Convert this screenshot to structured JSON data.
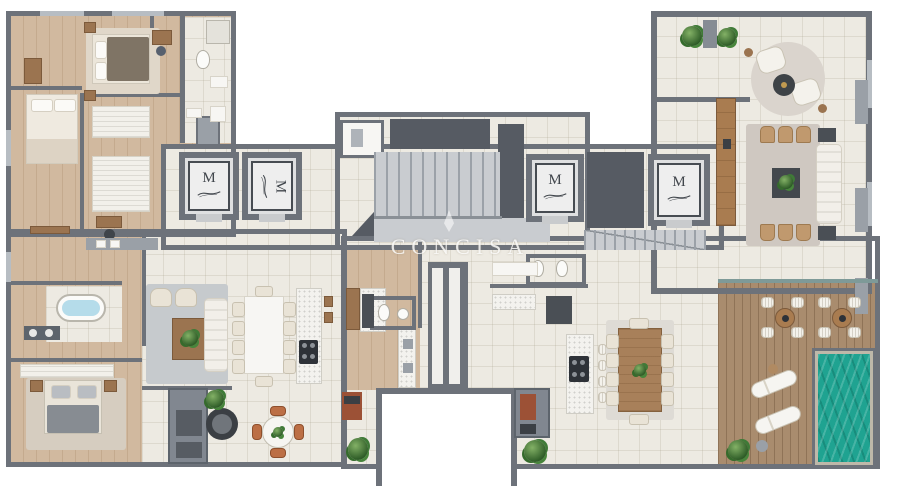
{
  "watermark": {
    "text": "CONCISA"
  },
  "elevator": {
    "logo": "M",
    "count": 4
  },
  "colors": {
    "wall": "#6d727a",
    "wall_dark": "#565b63",
    "wall_light": "#9aa0a7",
    "tile": "#edeae2",
    "wood": "#d1b99f",
    "deck": "#a98c6e",
    "rug_gray": "#c6cacd",
    "rug_beige": "#cfc8c1",
    "rug_light": "#dedbd5",
    "pool": "#1fa391",
    "sofa": "#f2efe9",
    "chair_tan": "#c0996e",
    "furniture_dark": "#43484d",
    "plant": "#3f7a37",
    "tub": "#b5dcea",
    "brick": "#9c5136",
    "terracotta": "#bc6f45",
    "stair": "#c9ccd0",
    "marble": "#f3f2ee"
  }
}
